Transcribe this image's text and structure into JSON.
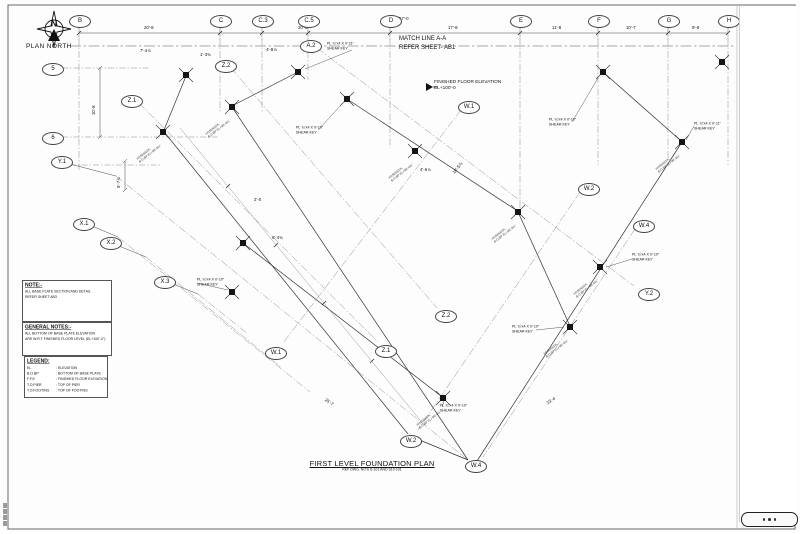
{
  "compass": {
    "label": "PLAN NORTH",
    "n": "N"
  },
  "grid": {
    "top": [
      {
        "label": "B"
      },
      {
        "label": "C"
      },
      {
        "label": "C.3"
      },
      {
        "label": "C.5"
      },
      {
        "label": "D"
      },
      {
        "label": "E"
      },
      {
        "label": "F"
      },
      {
        "label": "G"
      },
      {
        "label": "H"
      }
    ],
    "left": [
      {
        "label": "5"
      },
      {
        "label": "6"
      },
      {
        "label": "Y.1"
      },
      {
        "label": "X.1"
      },
      {
        "label": "X.2"
      },
      {
        "label": "X.3"
      }
    ],
    "field": [
      {
        "label": "Z.1"
      },
      {
        "label": "Z.2"
      },
      {
        "label": "A.2"
      },
      {
        "label": "W.1"
      },
      {
        "label": "W.2"
      },
      {
        "label": "W.4"
      },
      {
        "label": "Y.2"
      },
      {
        "label": "Z.2"
      },
      {
        "label": "Z.1"
      },
      {
        "label": "W.1"
      },
      {
        "label": "W.2"
      },
      {
        "label": "W.4"
      }
    ]
  },
  "dims": {
    "top_segments": [
      "20'-8",
      "20'-8",
      "17'-8",
      "11'-8",
      "10'-7",
      "9'-8"
    ],
    "overall": "57'-0",
    "vertical": [
      "10'-8",
      "5'-7⅞"
    ],
    "scattered": [
      "7'-4⅞",
      "1'-3¾",
      "4'-8⅞",
      "4'-6⅞",
      "10'-5⅞",
      "6'-4¾",
      "2'-0",
      "25'-7",
      "23'-4"
    ]
  },
  "match_line": {
    "line1": "MATCH LINE A-A",
    "line2": "REFER SHEET- AB1"
  },
  "ffe": {
    "text": "FINISHED FLOOR ELEVATION\nEL+100'-0"
  },
  "callouts": {
    "shear_key": "PL ¾\"x4 X 0'-10\"\nSHEAR KEY",
    "shear_key_alt": "PL ¾\"x4 X 0'-11\"\nSHEAR KEY",
    "column_tag": "HSS6X6X⅜\nB.O.BP EL+99'-4½\""
  },
  "note_box": {
    "title": "NOTE:-",
    "line1": "ALL BASE PLATE SECTION AND DETAIL",
    "line2": "REFER SHEET AB3"
  },
  "general_notes": {
    "title": "GENERAL NOTES:-",
    "line1": "ALL BOTTOM OF BASE PLATE ELEVATION",
    "line2": "ARE W.R.T FINISHED FLOOR LEVEL (EL+100'-0\")"
  },
  "legend": {
    "title": "LEGEND:",
    "rows": [
      {
        "abbr": "EL",
        "desc": ": ELEVATION"
      },
      {
        "abbr": "B.O.BP",
        "desc": ": BOTTOM OF BASE PLATE"
      },
      {
        "abbr": "F.F.E",
        "desc": ": FINISHED FLOOR ELEVATION"
      },
      {
        "abbr": "T.O.PIER",
        "desc": ": TOP OF PIER"
      },
      {
        "abbr": "T.O.FOOTING",
        "desc": ": TOP OF FOOTING"
      }
    ]
  },
  "title_block": {
    "title": "FIRST LEVEL FOUNDATION PLAN",
    "subtitle": "REF DWG. NO'S S-101 AND S10-101"
  }
}
